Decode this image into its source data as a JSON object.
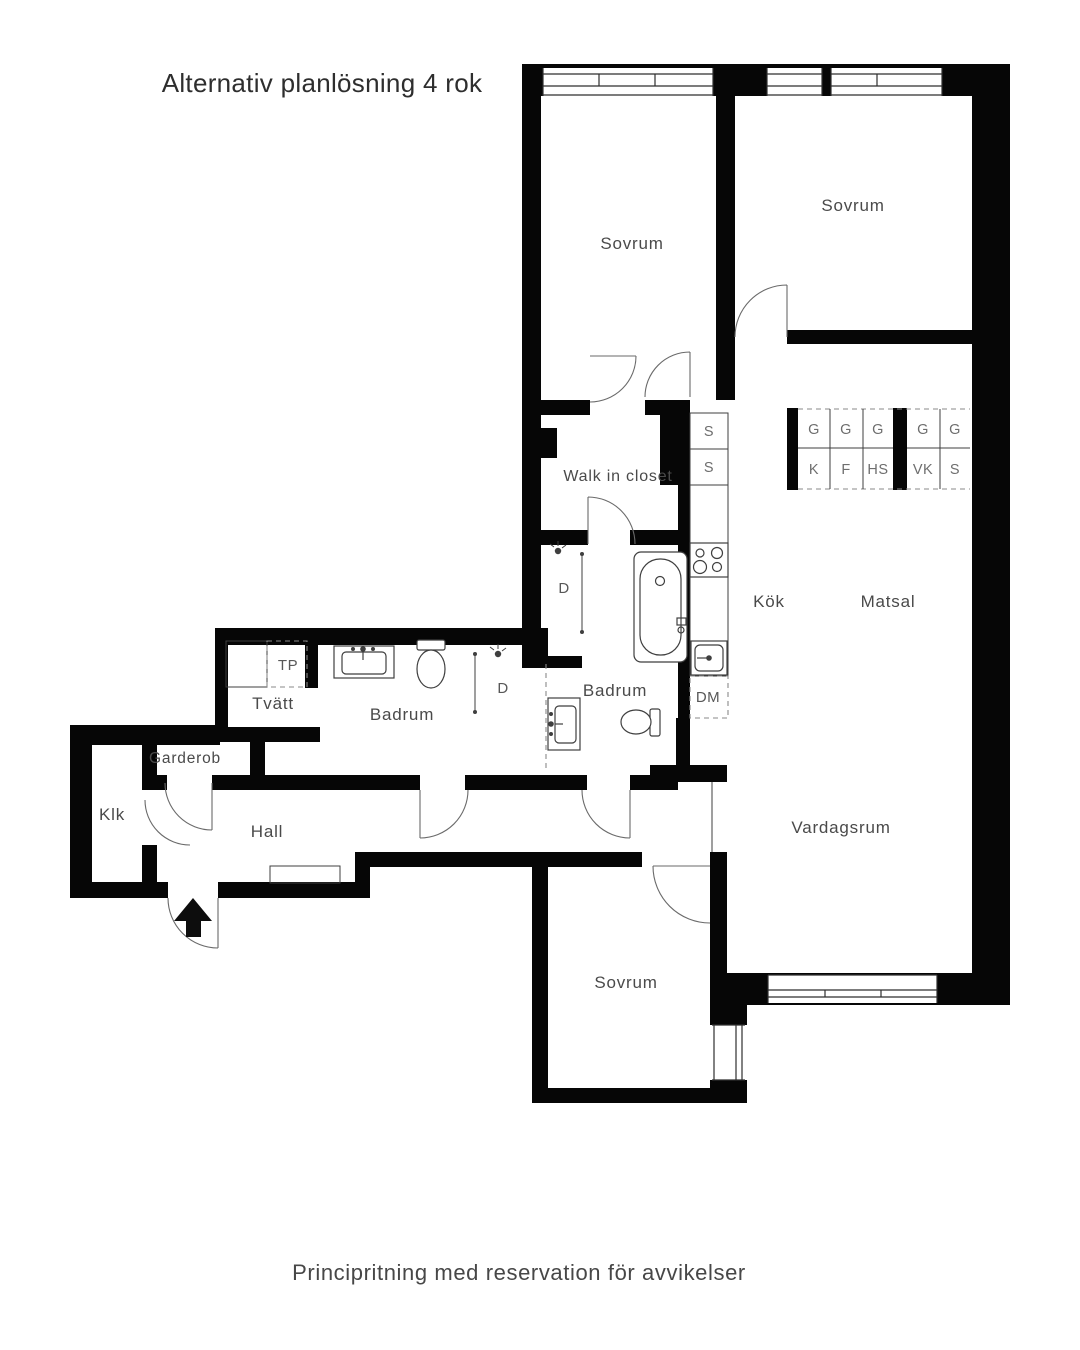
{
  "title": "Alternativ planlösning 4 rok",
  "footer": "Principritning med reservation för avvikelser",
  "rooms": {
    "sovrum_tl": "Sovrum",
    "sovrum_tr": "Sovrum",
    "walk_in_closet": "Walk in closet",
    "kok": "Kök",
    "matsal": "Matsal",
    "vardagsrum": "Vardagsrum",
    "badrum_left": "Badrum",
    "badrum_mid": "Badrum",
    "tvatt": "Tvätt",
    "garderob": "Garderob",
    "klk": "Klk",
    "hall": "Hall",
    "sovrum_bottom": "Sovrum"
  },
  "appliances": {
    "dm": "DM",
    "tp": "TP",
    "shower_mid": "D",
    "shower_left": "D"
  },
  "kitchen_cabinets": {
    "upper_group1": [
      "G",
      "G",
      "G"
    ],
    "upper_group2": [
      "G",
      "G"
    ],
    "lower_group1": [
      "K",
      "F",
      "HS"
    ],
    "lower_group2": [
      "VK",
      "S"
    ],
    "tall": [
      "S",
      "S"
    ]
  }
}
